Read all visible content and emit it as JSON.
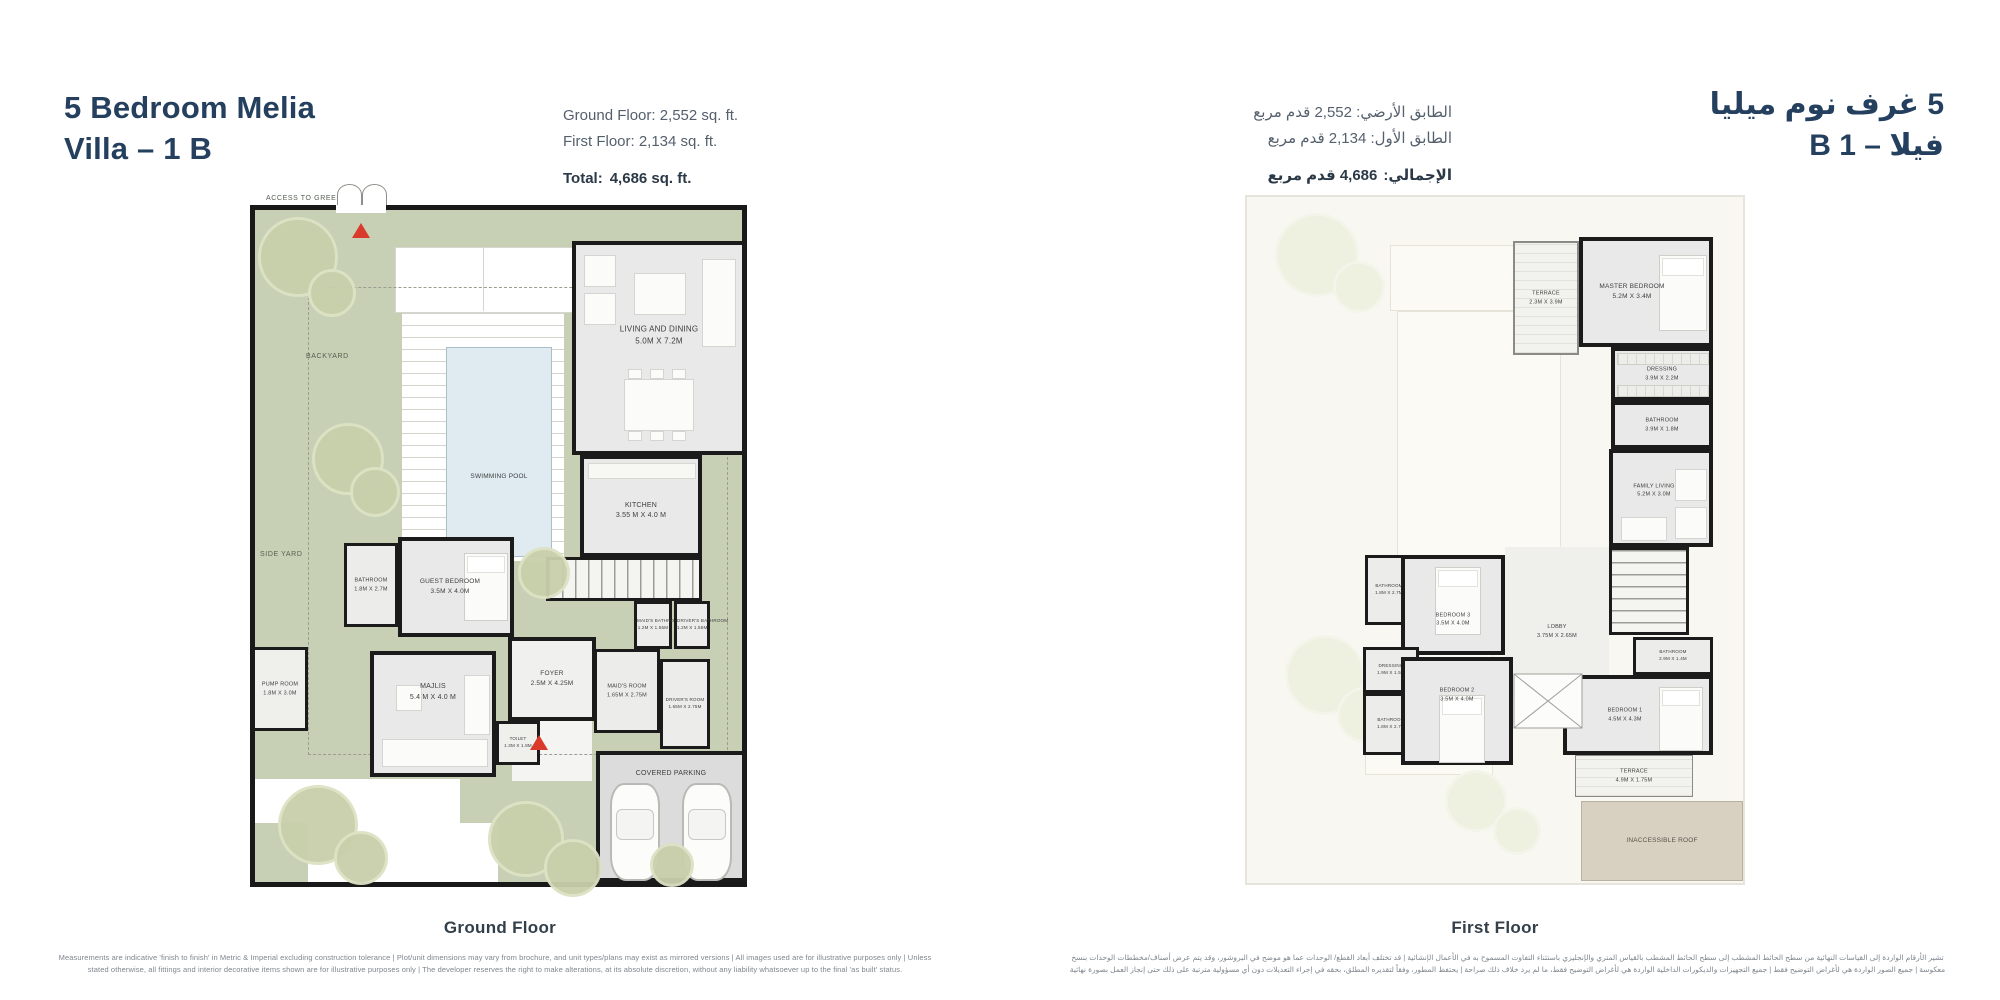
{
  "header": {
    "title_en_line1": "5 Bedroom Melia",
    "title_en_line2": "Villa – 1 B",
    "title_ar_line1": "5 غرف نوم ميليا",
    "title_ar_line2": "فيلا – B 1",
    "area_en": {
      "ground": "Ground Floor: 2,552 sq. ft.",
      "first": "First Floor: 2,134 sq. ft.",
      "total_label": "Total:",
      "total_value": "4,686 sq. ft."
    },
    "area_ar": {
      "ground": "الطابق الأرضي: 2,552 قدم مربع",
      "first": "الطابق الأول: 2,134 قدم مربع",
      "total_label": "الإجمالي:",
      "total_value": "4,686 قدم مربع"
    }
  },
  "ground_floor": {
    "caption": "Ground Floor",
    "labels": {
      "access_to_green": "ACCESS TO GREEN",
      "backyard": "BACKYARD",
      "side_yard": "SIDE YARD",
      "swimming_pool": "SWIMMING POOL",
      "covered_parking": "COVERED PARKING"
    },
    "rooms": [
      {
        "name": "LIVING AND DINING",
        "dims": "5.0M X 7.2M"
      },
      {
        "name": "KITCHEN",
        "dims": "3.55 M X 4.0 M"
      },
      {
        "name": "GUEST BEDROOM",
        "dims": "3.5M X 4.0M"
      },
      {
        "name": "BATHROOM",
        "dims": "1.8M X 2.7M"
      },
      {
        "name": "MAJLIS",
        "dims": "5.4 M X 4.0 M"
      },
      {
        "name": "FOYER",
        "dims": "2.5M X 4.25M"
      },
      {
        "name": "TOILET",
        "dims": "1.3M X 1.8M"
      },
      {
        "name": "MAID'S ROOM",
        "dims": "1.65M X 2.75M"
      },
      {
        "name": "DRIVER'S ROOM",
        "dims": "1.65M X 2.75M"
      },
      {
        "name": "MAID'S BATHROOM",
        "dims": "1.2M X 1.55M"
      },
      {
        "name": "DRIVER'S BATHROOM",
        "dims": "1.2M X 1.55M"
      },
      {
        "name": "PUMP ROOM",
        "dims": "1.8M X 3.0M"
      }
    ]
  },
  "first_floor": {
    "caption": "First Floor",
    "labels": {
      "inaccessible_roof": "INACCESSIBLE ROOF"
    },
    "rooms": [
      {
        "name": "TERRACE",
        "dims": "2.3M X 3.9M"
      },
      {
        "name": "MASTER BEDROOM",
        "dims": "5.2M X 3.4M"
      },
      {
        "name": "DRESSING",
        "dims": "3.9M X 2.2M"
      },
      {
        "name": "BATHROOM",
        "dims": "3.9M X 1.8M"
      },
      {
        "name": "FAMILY LIVING",
        "dims": "5.2M X 3.0M"
      },
      {
        "name": "BATHROOM",
        "dims": "1.8M X 2.7M"
      },
      {
        "name": "BEDROOM 3",
        "dims": "3.5M X 4.0M"
      },
      {
        "name": "LOBBY",
        "dims": "3.75M X 2.65M"
      },
      {
        "name": "DRESSING",
        "dims": "1.9M X 1.5M"
      },
      {
        "name": "BATHROOM",
        "dims": "1.8M X 2.7M"
      },
      {
        "name": "BEDROOM 2",
        "dims": "3.5M X 4.0M"
      },
      {
        "name": "BATHROOM",
        "dims": "2.9M X 1.4M"
      },
      {
        "name": "BEDROOM 1",
        "dims": "4.5M X 4.3M"
      },
      {
        "name": "TERRACE",
        "dims": "4.9M X 1.75M"
      }
    ]
  },
  "footer": {
    "disclaimer_en": "Measurements are indicative 'finish to finish' in Metric & Imperial excluding construction tolerance | Plot/unit dimensions may vary from brochure, and unit types/plans may exist as mirrored versions | All images used are for illustrative purposes only | Unless stated otherwise, all fittings and interior decorative items shown are for illustrative purposes only | The developer reserves the right to make alterations, at its absolute discretion, without any liability whatsoever up to the final 'as built' status.",
    "disclaimer_ar": "تشير الأرقام الواردة إلى القياسات النهائية من سطح الحائط المشطب إلى سطح الحائط المشطب بالقياس المتري والإنجليزي باستثناء التفاوت المسموح به في الأعمال الإنشائية | قد تختلف أبعاد القطع/ الوحدات عما هو موضح في البروشور، وقد يتم عرض أصناف/مخططات الوحدات بنسخ معكوسة | جميع الصور الواردة هي لأغراض التوضيح فقط | جميع التجهيزات والديكورات الداخلية الواردة هي لأغراض التوضيح فقط، ما لم يرد خلاف ذلك صراحة | يحتفظ المطور، وفقاً لتقديره المطلق، بحقه في إجراء التعديلات دون أي مسؤولية مترتبة على ذلك حتى إنجاز العمل بصورة نهائية"
  },
  "colors": {
    "accent_navy": "#24405e",
    "plot_green": "#c7d0b5",
    "pool_blue": "#dfebf1",
    "roof_tan": "#d8d1c2",
    "arrow_red": "#d93a2b",
    "wall_black": "#1b1b1b"
  }
}
